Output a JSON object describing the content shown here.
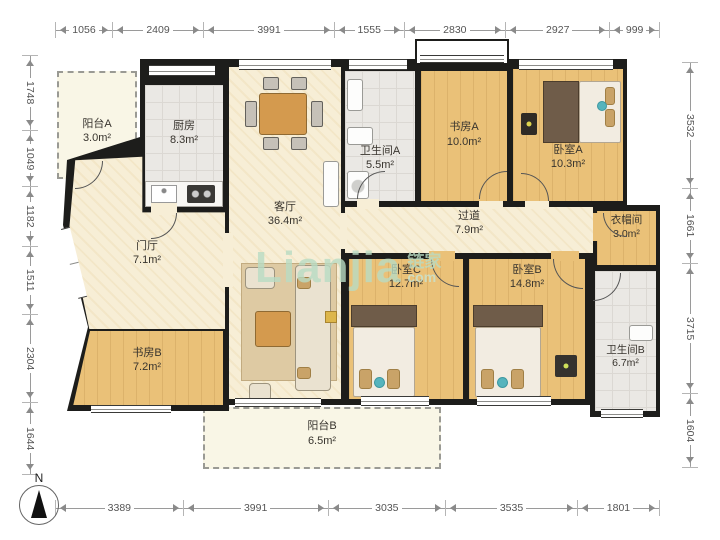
{
  "dimensions": {
    "top": [
      1056,
      2409,
      3991,
      1555,
      2830,
      2927,
      999
    ],
    "bottom": [
      3389,
      3991,
      3035,
      3535,
      1801
    ],
    "left": [
      1748,
      1049,
      1182,
      1511,
      2304,
      1644
    ],
    "right": [
      3532,
      1661,
      3715,
      1604
    ]
  },
  "rooms": [
    {
      "id": "balcony-a",
      "name": "阳台A",
      "area": "3.0m²"
    },
    {
      "id": "kitchen",
      "name": "厨房",
      "area": "8.3m²"
    },
    {
      "id": "living-room",
      "name": "客厅",
      "area": "36.4m²"
    },
    {
      "id": "foyer",
      "name": "门厅",
      "area": "7.1m²"
    },
    {
      "id": "bathroom-a",
      "name": "卫生间A",
      "area": "5.5m²"
    },
    {
      "id": "study-a",
      "name": "书房A",
      "area": "10.0m²"
    },
    {
      "id": "bedroom-a",
      "name": "卧室A",
      "area": "10.3m²"
    },
    {
      "id": "hallway",
      "name": "过道",
      "area": "7.9m²"
    },
    {
      "id": "cloakroom",
      "name": "衣帽间",
      "area": "3.0m²"
    },
    {
      "id": "bedroom-c",
      "name": "卧室C",
      "area": "12.7m²"
    },
    {
      "id": "bedroom-b",
      "name": "卧室B",
      "area": "14.8m²"
    },
    {
      "id": "study-b",
      "name": "书房B",
      "area": "7.2m²"
    },
    {
      "id": "bathroom-b",
      "name": "卫生间B",
      "area": "6.7m²"
    },
    {
      "id": "balcony-b",
      "name": "阳台B",
      "area": "6.5m²"
    }
  ],
  "compass": {
    "label": "N"
  },
  "watermark": {
    "brand": "Lianjia",
    "cn": "链家",
    "suffix": "com",
    "color": "#b9dcc4"
  },
  "colors": {
    "wall": "#1d1d1b",
    "wood_floor": "#eac178",
    "cream_floor": "#f7eed6",
    "tile_floor": "#eae8e4",
    "balcony_floor": "#f9f6e6",
    "dimension_text": "#555555"
  }
}
